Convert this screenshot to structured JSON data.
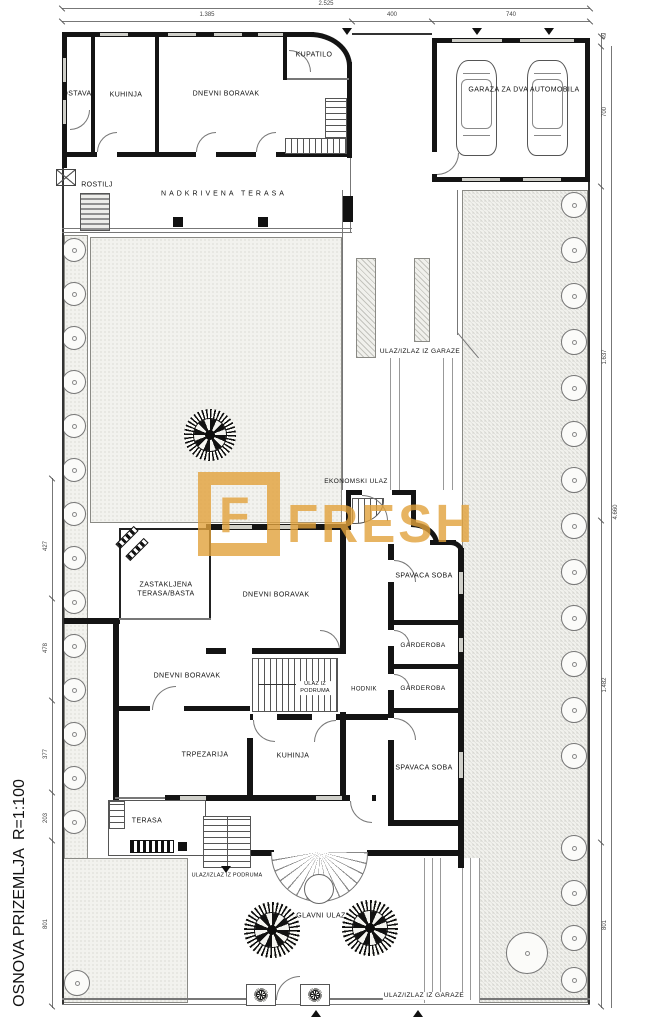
{
  "title": "OSNOVA PRIZEMLJA  R=1:100",
  "watermark": {
    "logo_letter": "F",
    "brand": "FRESH",
    "color": "#E2A23B"
  },
  "guest_house": {
    "ostava": "OSTAVA",
    "kuhinja": "KUHINJA",
    "dnevni_boravak": "DNEVNI BORAVAK",
    "kupatilo": "KUPATILO",
    "rostilj": "ROSTILJ",
    "nadkrivena_terasa": "NADKRIVENA TERASA"
  },
  "garage": {
    "label": "GARAZA ZA DVA AUTOMOBILA"
  },
  "site": {
    "ulaz_izlaz_iz_garaze_top": "ULAZ/IZLAZ IZ GARAZE",
    "ekonomski_ulaz": "EKONOMSKI ULAZ",
    "ulaz_izlaz_iz_podruma": "ULAZ/IZLAZ IZ PODRUMA",
    "glavni_ulaz": "GLAVNI ULAZ",
    "ulaz_izlaz_iz_garaze_bottom": "ULAZ/IZLAZ IZ GARAZE"
  },
  "house": {
    "zastakljena_terasa": "ZASTAKLJENA TERASA/BASTA",
    "dnevni_boravak_1": "DNEVNI BORAVAK",
    "dnevni_boravak_2": "DNEVNI BORAVAK",
    "spavaca_soba_1": "SPAVACA SOBA",
    "garderoba_1": "GARDEROBA",
    "garderoba_2": "GARDEROBA",
    "spavaca_soba_2": "SPAVACA SOBA",
    "ulaz_iz_podruma": "ULAZ IZ PODRUMA",
    "hodnik": "HODNIK",
    "trpezarija": "TRPEZARIJA",
    "kuhinja": "KUHINJA",
    "terasa": "TERASA"
  },
  "dims": {
    "top_total": "2.525",
    "top_1": "1.385",
    "top_2": "400",
    "top_3": "740",
    "right_1": "49",
    "right_2": "700",
    "right_3": "1.637",
    "right_4": "1.482",
    "right_5": "801",
    "right_total": "4.660",
    "left_1": "427",
    "left_2": "478",
    "left_3": "377",
    "left_4": "203",
    "left_5": "801"
  }
}
